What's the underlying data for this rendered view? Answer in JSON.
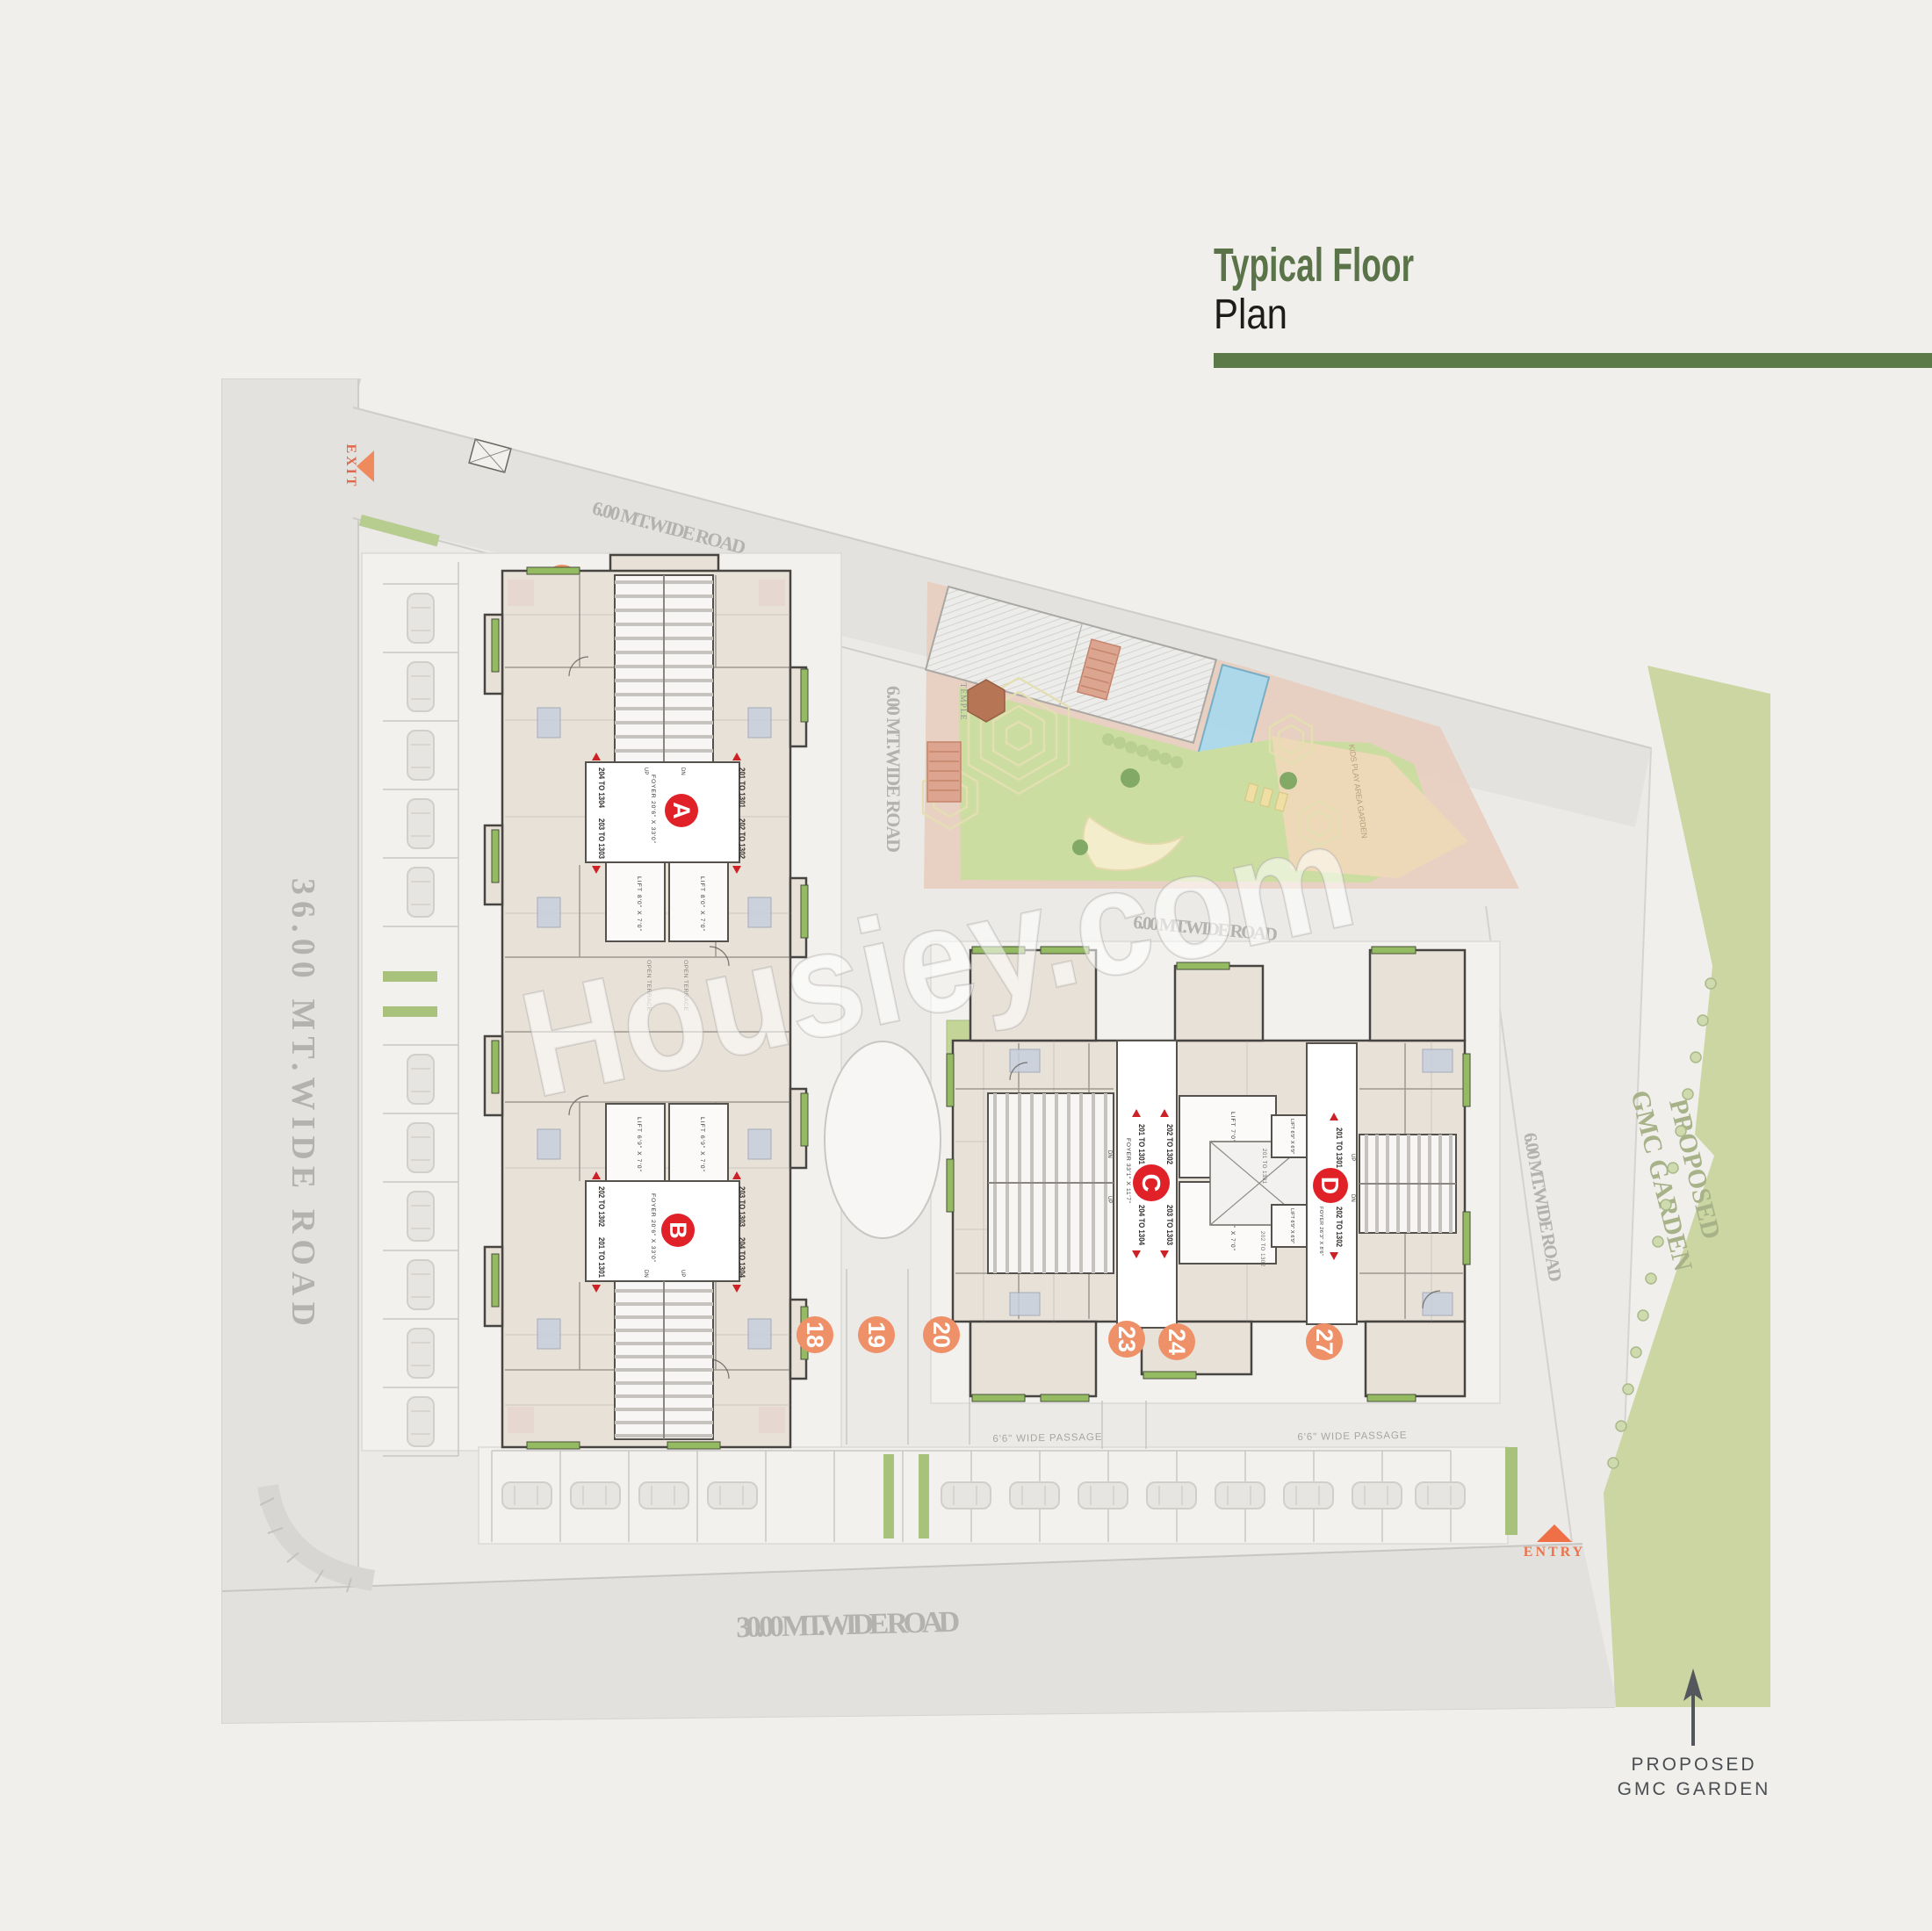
{
  "title": {
    "line1": "Typical Floor",
    "line2": "Plan"
  },
  "watermark": "Housiey.com",
  "colors": {
    "accent_green": "#5b7a47",
    "title_green": "#5a7349",
    "badge_red": "#e02127",
    "plot_orange": "#ee9168",
    "balcony_green": "#95bb62",
    "garden_green": "#ccd6a2",
    "pool_blue": "#a8d8ec"
  },
  "roads": {
    "left": "36.00 MT.WIDE ROAD",
    "bottom": "30.00 MT.WIDE ROAD",
    "top": "6.00 MT.WIDE ROAD",
    "inner_vertical": "6.00 MT.WIDE ROAD",
    "inner_horizontal": "6.00 MT.WIDE ROAD",
    "inner_right": "6.00 MT.WIDE ROAD"
  },
  "markers": {
    "exit": "EXIT",
    "entry": "ENTRY"
  },
  "garden_strip": {
    "line1": "PROPOSED",
    "line2": "GMC GARDEN"
  },
  "garden_callout": {
    "line1": "PROPOSED",
    "line2": "GMC GARDEN"
  },
  "amenity": {
    "temple": "TEMPLE",
    "kids_play": "KIDS PLAY AREA GARDEN"
  },
  "passages": {
    "label1": "6'6\" WIDE PASSAGE",
    "label2": "6'6\" WIDE PASSAGE"
  },
  "terraces": {
    "label1": "OPEN TERRACE",
    "label2": "OPEN TERRACE"
  },
  "open_sky": {
    "top": "201 TO 1301",
    "bottom": "202 TO 1302"
  },
  "plots": {
    "n18": "18",
    "n19": "19",
    "n20": "20",
    "n23": "23",
    "n24": "24",
    "n27": "27"
  },
  "towers": [
    {
      "letter": "A",
      "foyer": "FOYER 20'6\" X 33'0\"",
      "unit_tl": "204 TO 1304",
      "unit_bl": "203 TO 1303",
      "unit_tr": "201 TO 1301",
      "unit_br": "202 TO 1302",
      "lift1": "LIFT 8'0\" X 7'0\"",
      "lift2": "LIFT 8'0\" X 7'0\"",
      "up": "UP",
      "dn": "DN"
    },
    {
      "letter": "B",
      "foyer": "FOYER 20'6\" X 33'0\"",
      "unit_tl": "202 TO 1302",
      "unit_bl": "201 TO 1301",
      "unit_tr": "203 TO 1303",
      "unit_br": "204 TO 1304",
      "lift1": "LIFT 6'9\" X 7'0\"",
      "lift2": "LIFT 6'9\" X 7'0\"",
      "up": "UP",
      "dn": "DN"
    },
    {
      "letter": "C",
      "foyer": "FOYER 33'1\" X 11'7\"",
      "unit_tl": "201 TO 1301",
      "unit_bl": "204 TO 1304",
      "unit_tr": "202 TO 1302",
      "unit_br": "203 TO 1303",
      "lift1": "LIFT 7'0\" X 7'0\"",
      "lift2": "LIFT 7'0\" X 7'0\"",
      "up": "UP",
      "dn": "DN"
    },
    {
      "letter": "D",
      "foyer": "FOYER 26'3\" X 8'6\"",
      "unit_top": "201 TO 1301",
      "unit_bottom": "202 TO 1302",
      "lift1": "LIFT 6'9\" X 6'9\"",
      "lift2": "LIFT 6'9\" X 6'9\"",
      "up": "UP",
      "dn": "DN"
    }
  ]
}
